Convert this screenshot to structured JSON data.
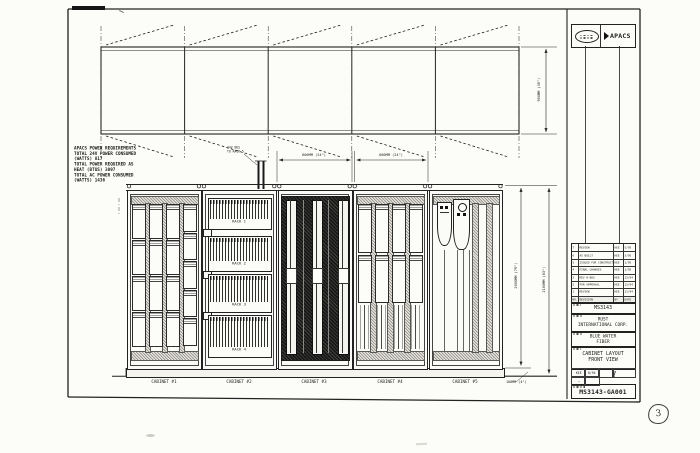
{
  "sheet": {
    "stamp_number": "3"
  },
  "logos": {
    "apacs": "APACS"
  },
  "power_notes": {
    "lines": "APACS POWER REQUIREMENTS\nTOTAL 24V POWER CONSUMED\n(WATTS) 817\nTOTAL POWER REQUIRED AS\nHEAT (BTUS) 3097\nTOTAL AC POWER CONSUMED\n(WATTS) 1436"
  },
  "bus_note": {
    "text": "24V BUS\nTO RACK 5"
  },
  "dimensions": {
    "cabinet3_width": "600MM (24\")",
    "cabinet4_width": "600MM (24\")",
    "plan_depth": "900MM (36\")",
    "cabinet_height": "2000MM (79\")",
    "overall_height": "2100MM (83\")",
    "base_height": "100MM (4\")"
  },
  "elevation": {
    "cabinets": [
      {
        "label": "CABINET #1"
      },
      {
        "label": "CABINET #2",
        "racks": [
          "RACK 1",
          "RACK 2",
          "RACK 3",
          "RACK 4"
        ]
      },
      {
        "label": "CABINET #3"
      },
      {
        "label": "CABINET #4"
      },
      {
        "label": "CABINET #5"
      }
    ]
  },
  "revision_table": {
    "rows": [
      {
        "no": "7",
        "desc": "REVIEW",
        "by": "KEE",
        "date": "5/95"
      },
      {
        "no": "6",
        "desc": "AS BUILT",
        "by": "KEE",
        "date": "3/95"
      },
      {
        "no": "5",
        "desc": "ISSUED FOR CONSTRUCTION",
        "by": "KEE",
        "date": "1/95"
      },
      {
        "no": "4",
        "desc": "FINAL CHANGES",
        "by": "KEE",
        "date": "1/95"
      },
      {
        "no": "3",
        "desc": "REV H-BUS",
        "by": "KEE",
        "date": "12/94"
      },
      {
        "no": "2",
        "desc": "FOR APPROVAL",
        "by": "KEE",
        "date": "12/94"
      },
      {
        "no": "1",
        "desc": "REVIEW",
        "by": "KEE",
        "date": "11/94"
      },
      {
        "no": "NO.",
        "desc": "REVISION",
        "by": "BY",
        "date": "DATE"
      }
    ]
  },
  "title_block": {
    "job_no": "MS3143",
    "company": "RUST\nINTERNATIONAL CORP.",
    "project": "BLUE WATER\nFIBER",
    "drawing_title": "CABINET LAYOUT\nFRONT VIEW",
    "drawn_by": "KEE",
    "date": "8/94",
    "scale": "—",
    "sheet": "1",
    "drawing_no": "MS3143-GA001"
  }
}
